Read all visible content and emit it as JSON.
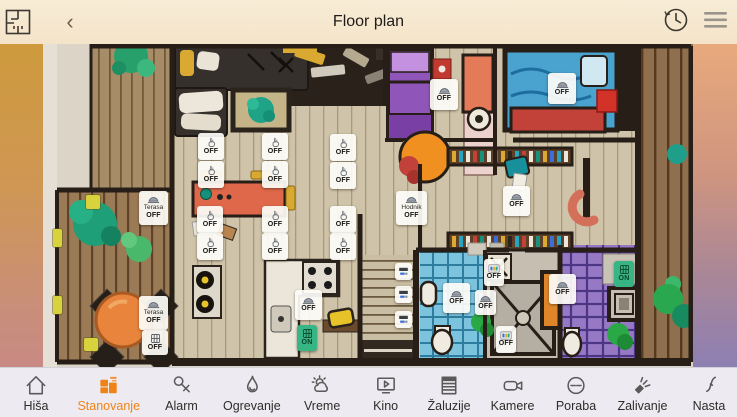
{
  "header": {
    "title": "Floor plan",
    "back_glyph": "‹"
  },
  "nav": {
    "active_color": "#ef8318",
    "items": [
      {
        "id": "hisa",
        "label": "Hiša",
        "icon": "house",
        "active": false
      },
      {
        "id": "stanovanje",
        "label": "Stanovanje",
        "icon": "floorplan",
        "active": true
      },
      {
        "id": "alarm",
        "label": "Alarm",
        "icon": "key",
        "active": false
      },
      {
        "id": "ogrevanje",
        "label": "Ogrevanje",
        "icon": "flame",
        "active": false
      },
      {
        "id": "vreme",
        "label": "Vreme",
        "icon": "weather",
        "active": false
      },
      {
        "id": "kino",
        "label": "Kino",
        "icon": "cinema",
        "active": false
      },
      {
        "id": "zaluzije",
        "label": "Žaluzije",
        "icon": "blinds",
        "active": false
      },
      {
        "id": "kamere",
        "label": "Kamere",
        "icon": "camera",
        "active": false
      },
      {
        "id": "poraba",
        "label": "Poraba",
        "icon": "gauge",
        "active": false
      },
      {
        "id": "zalivanje",
        "label": "Zalivanje",
        "icon": "sprinkler",
        "active": false
      },
      {
        "id": "nastavitve",
        "label": "Nasta",
        "icon": "tool",
        "active": false
      }
    ]
  },
  "floorplan": {
    "controls": [
      {
        "name": "light-switch",
        "icon": "hand",
        "label": "OFF",
        "x": 198,
        "y": 133,
        "w": 26,
        "h": 27
      },
      {
        "name": "light-switch",
        "icon": "hand",
        "label": "OFF",
        "x": 262,
        "y": 133,
        "w": 26,
        "h": 27
      },
      {
        "name": "light-switch",
        "icon": "hand",
        "label": "OFF",
        "x": 330,
        "y": 134,
        "w": 26,
        "h": 27
      },
      {
        "name": "light-switch",
        "icon": "hand",
        "label": "OFF",
        "x": 198,
        "y": 161,
        "w": 26,
        "h": 27
      },
      {
        "name": "light-switch",
        "icon": "hand",
        "label": "OFF",
        "x": 262,
        "y": 161,
        "w": 26,
        "h": 27
      },
      {
        "name": "light-switch",
        "icon": "hand",
        "label": "OFF",
        "x": 330,
        "y": 162,
        "w": 26,
        "h": 27
      },
      {
        "name": "light-switch",
        "icon": "hand",
        "label": "OFF",
        "x": 197,
        "y": 206,
        "w": 26,
        "h": 27
      },
      {
        "name": "light-switch",
        "icon": "hand",
        "label": "OFF",
        "x": 262,
        "y": 206,
        "w": 26,
        "h": 27
      },
      {
        "name": "light-switch",
        "icon": "hand",
        "label": "OFF",
        "x": 330,
        "y": 206,
        "w": 26,
        "h": 27
      },
      {
        "name": "light-switch",
        "icon": "hand",
        "label": "OFF",
        "x": 197,
        "y": 233,
        "w": 26,
        "h": 27
      },
      {
        "name": "light-switch",
        "icon": "hand",
        "label": "OFF",
        "x": 262,
        "y": 233,
        "w": 26,
        "h": 27
      },
      {
        "name": "light-switch",
        "icon": "hand",
        "label": "OFF",
        "x": 330,
        "y": 233,
        "w": 26,
        "h": 27
      },
      {
        "name": "terrace-light",
        "icon": "lamp",
        "sublabel": "Terasa",
        "label": "OFF",
        "x": 139,
        "y": 191,
        "w": 29,
        "h": 34
      },
      {
        "name": "terrace-light",
        "icon": "lamp",
        "sublabel": "Terasa",
        "label": "OFF",
        "x": 139,
        "y": 296,
        "w": 29,
        "h": 34
      },
      {
        "name": "terrace-aux-switch",
        "icon": "grill",
        "label": "OFF",
        "x": 142,
        "y": 330,
        "w": 26,
        "h": 25
      },
      {
        "name": "hallway-light",
        "icon": "lamp",
        "sublabel": "Hodnik",
        "label": "OFF",
        "x": 396,
        "y": 191,
        "w": 31,
        "h": 34
      },
      {
        "name": "bedroom-light",
        "icon": "lamp",
        "label": "OFF",
        "x": 430,
        "y": 79,
        "w": 28,
        "h": 31
      },
      {
        "name": "bedroom-light",
        "icon": "lamp",
        "label": "OFF",
        "x": 548,
        "y": 73,
        "w": 28,
        "h": 31
      },
      {
        "name": "corridor-light",
        "icon": "lamp",
        "label": "OFF",
        "x": 503,
        "y": 186,
        "w": 27,
        "h": 30
      },
      {
        "name": "bathroom-light",
        "icon": "lamp",
        "label": "OFF",
        "x": 443,
        "y": 283,
        "w": 27,
        "h": 30
      },
      {
        "name": "bathroom-light",
        "icon": "lamp",
        "label": "OFF",
        "x": 549,
        "y": 274,
        "w": 27,
        "h": 30
      },
      {
        "name": "kitchen-light",
        "icon": "lamp",
        "label": "OFF",
        "x": 295,
        "y": 290,
        "w": 27,
        "h": 30
      },
      {
        "name": "appliance-switch",
        "icon": "dots",
        "label": "OFF",
        "x": 484,
        "y": 259,
        "w": 20,
        "h": 27
      },
      {
        "name": "appliance-switch",
        "icon": "dots",
        "label": "OFF",
        "x": 496,
        "y": 326,
        "w": 20,
        "h": 27
      },
      {
        "name": "shower-light",
        "icon": "lamp",
        "label": "OFF",
        "x": 475,
        "y": 290,
        "w": 21,
        "h": 25
      },
      {
        "name": "on-switch",
        "icon": "grill",
        "label": "ON",
        "x": 297,
        "y": 325,
        "w": 20,
        "h": 26,
        "variant": "green"
      },
      {
        "name": "on-switch",
        "icon": "grill",
        "label": "ON",
        "x": 614,
        "y": 261,
        "w": 20,
        "h": 26,
        "variant": "green"
      },
      {
        "name": "blind-control",
        "icon": "bar",
        "label": "",
        "x": 395,
        "y": 263,
        "w": 17,
        "h": 17
      },
      {
        "name": "blind-control",
        "icon": "bar",
        "label": "",
        "x": 395,
        "y": 286,
        "w": 17,
        "h": 17
      },
      {
        "name": "blind-control",
        "icon": "bar",
        "label": "",
        "x": 395,
        "y": 311,
        "w": 17,
        "h": 17
      }
    ],
    "markers": [
      {
        "color": "#d8d23c",
        "x": 86,
        "y": 195,
        "w": 14,
        "h": 14
      },
      {
        "color": "#d8d23c",
        "x": 53,
        "y": 229,
        "w": 9,
        "h": 18
      },
      {
        "color": "#d8d23c",
        "x": 53,
        "y": 296,
        "w": 9,
        "h": 18
      },
      {
        "color": "#d8d23c",
        "x": 84,
        "y": 338,
        "w": 14,
        "h": 13
      }
    ]
  }
}
